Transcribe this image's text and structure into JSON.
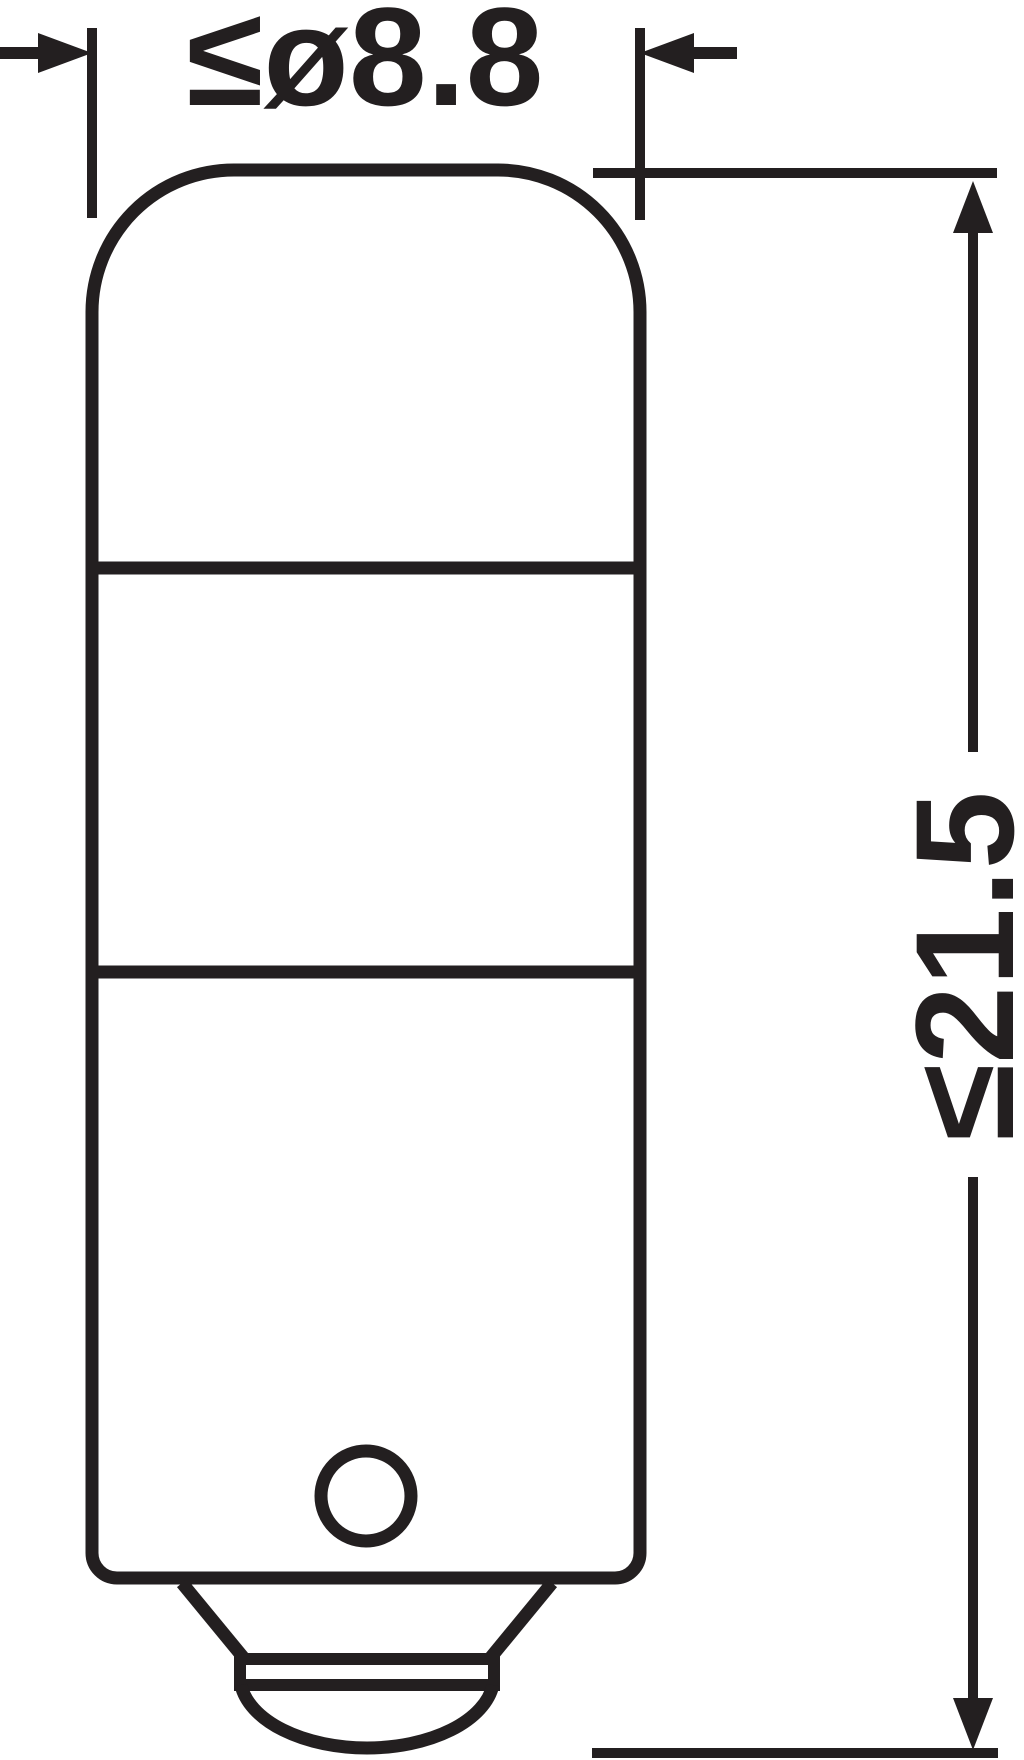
{
  "drawing": {
    "dimensions": {
      "diameter_label": "≤ø8.8",
      "length_label": "≤21.5"
    },
    "colors": {
      "line": "#231f20",
      "background": "#ffffff"
    }
  }
}
